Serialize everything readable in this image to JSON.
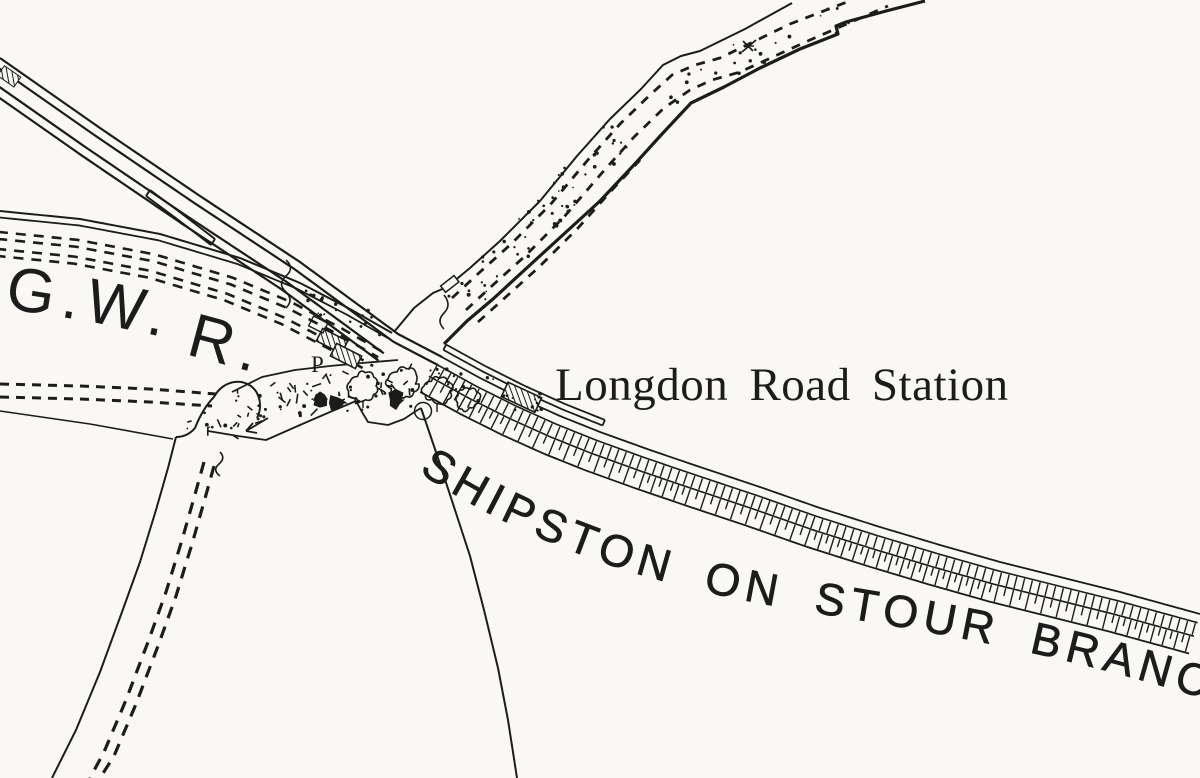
{
  "map": {
    "labels": {
      "gwr": [
        "G.",
        "W.",
        "R."
      ],
      "station": "Longdon Road Station",
      "branch": "SHIPSTON ON STOUR BRANCH",
      "pump": "P"
    },
    "colors": {
      "ink": "#1c1c1c",
      "paper": "#f9f8f5"
    }
  }
}
